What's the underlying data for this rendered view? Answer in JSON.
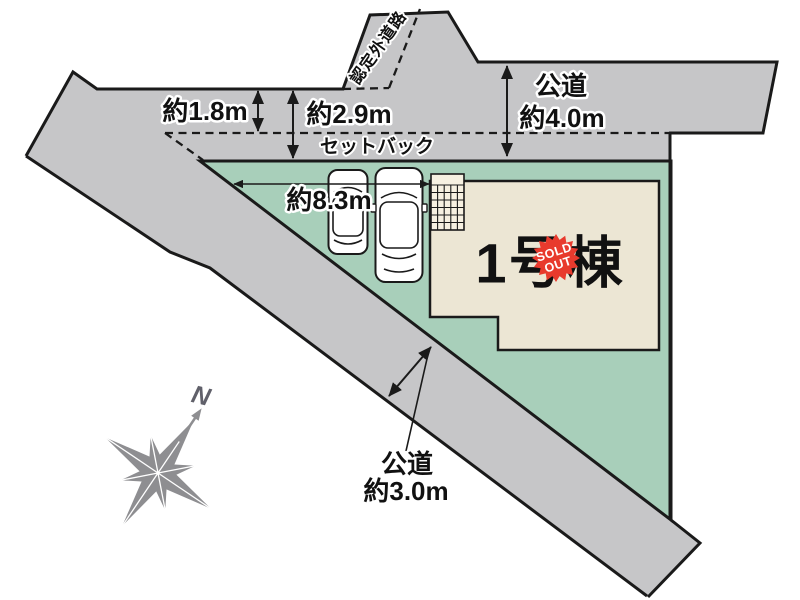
{
  "plot_map": {
    "north_road": {
      "name": "公道",
      "width": "約4.0m",
      "current_width": "約1.8m",
      "total_depth": "約2.9m",
      "setback_label": "セットバック"
    },
    "uncertified_road": {
      "label": "認定外道路"
    },
    "south_road": {
      "name": "公道",
      "width": "約3.0m"
    },
    "site": {
      "frontage": "約8.3m"
    },
    "building": {
      "name": "1号棟",
      "badge_line1": "SOLD",
      "badge_line2": "OUT"
    },
    "compass": {
      "north_label": "N"
    },
    "colors": {
      "road_fill": "#c6c6c8",
      "site_fill": "#a8cfba",
      "building_fill": "#ece6d4",
      "tile_fill": "#f6f0e1",
      "badge_red": "#e83a2d",
      "line": "#1a1a1a",
      "compass_gray": "#8e8e91"
    }
  }
}
